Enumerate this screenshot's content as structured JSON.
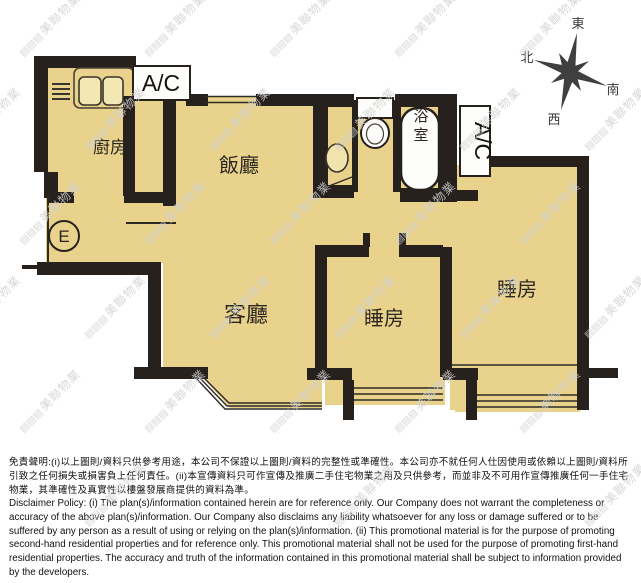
{
  "floor_plan": {
    "flat_label": "E",
    "rooms": {
      "kitchen": "廚房",
      "dining_room": "飯廳",
      "living_room": "客廳",
      "bedroom_middle": "睡房",
      "bedroom_right": "睡房",
      "bathroom": "浴室"
    },
    "ac_unit_top": "A/C",
    "ac_unit_right": "A/C",
    "compass": {
      "east": "東",
      "south": "南",
      "west": "西",
      "north": "北"
    }
  },
  "watermark": {
    "logo_glyphs": "▤▤▤",
    "text": "美聯物業"
  },
  "disclaimer": {
    "chinese": "免責聲明:(i)以上圖則/資料只供參考用途，本公司不保證以上圖則/資料的完整性或準確性。本公司亦不就任何人仕因使用或依賴以上圖則/資料所引致之任何損失或損害負上任何責任。(ii)本宣傳資料只可作宣傳及推廣二手住宅物業之用及只供參考，而並非及不可用作宣傳推廣任何一手住宅物業，其準確性及真實性以樓盤發展商提供的資料為準。",
    "english": "Disclaimer Policy: (i) The plan(s)/information contained herein are for reference only. Our Company does not warrant the completeness or accuracy of the above plan(s)/information. Our Company also disclaims any liability whatsoever for any loss or damage suffered or to be suffered by any person as a result of using or relying on the plan(s)/information. (ii) This promotional material is for the purpose of promoting second-hand residential properties and for reference only. This promotional material shall not be used for the purpose of promoting first-hand residential properties. The accuracy and truth of the information contained in this promotional material shall be subject to information provided by the developers."
  },
  "colors": {
    "floor_fill": "#e9d38c",
    "wall": "#26211d",
    "watermark": "#d2d2d2"
  }
}
